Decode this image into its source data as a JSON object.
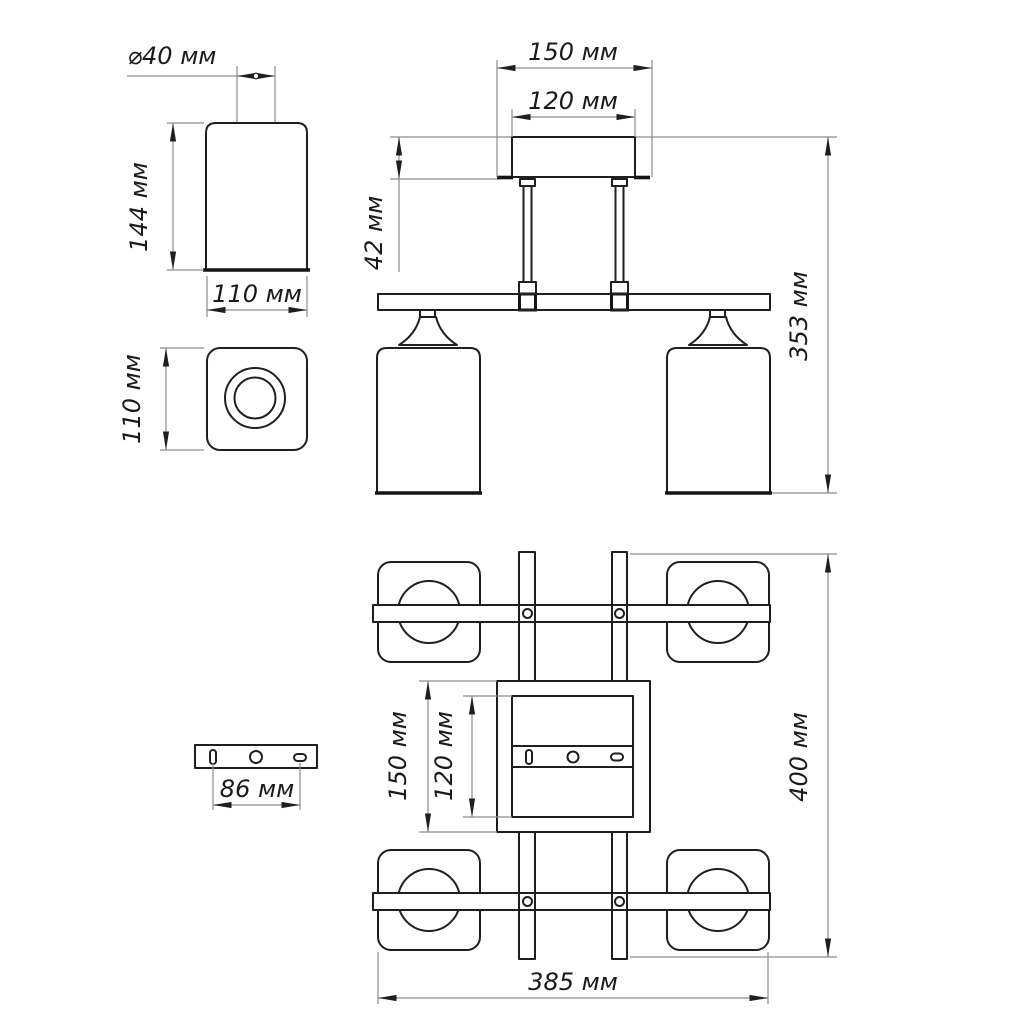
{
  "drawing": {
    "language": "ru",
    "unit": "мм",
    "colors": {
      "background": "#ffffff",
      "object_line": "#1f1f1f",
      "dimension_line": "#8c8c8c",
      "text": "#1a1a1a"
    },
    "dims": {
      "shade_hole_d40": {
        "label": "⌀40 мм",
        "value": 40
      },
      "shade_h144": {
        "label": "144 мм",
        "value": 144
      },
      "shade_w110": {
        "label": "110 мм",
        "value": 110
      },
      "shade_top_110": {
        "label": "110 мм",
        "value": 110
      },
      "front_canopy_150": {
        "label": "150 мм",
        "value": 150
      },
      "front_canopy_120": {
        "label": "120 мм",
        "value": 120
      },
      "front_canopy_h42": {
        "label": "42 мм",
        "value": 42
      },
      "front_total_h353": {
        "label": "353 мм",
        "value": 353
      },
      "plan_canopy_150": {
        "label": "150 мм",
        "value": 150
      },
      "plan_canopy_120": {
        "label": "120 мм",
        "value": 120
      },
      "plan_total_400": {
        "label": "400 мм",
        "value": 400
      },
      "plan_total_385": {
        "label": "385 мм",
        "value": 385
      },
      "bracket_holes_86": {
        "label": "86 мм",
        "value": 86
      }
    }
  }
}
